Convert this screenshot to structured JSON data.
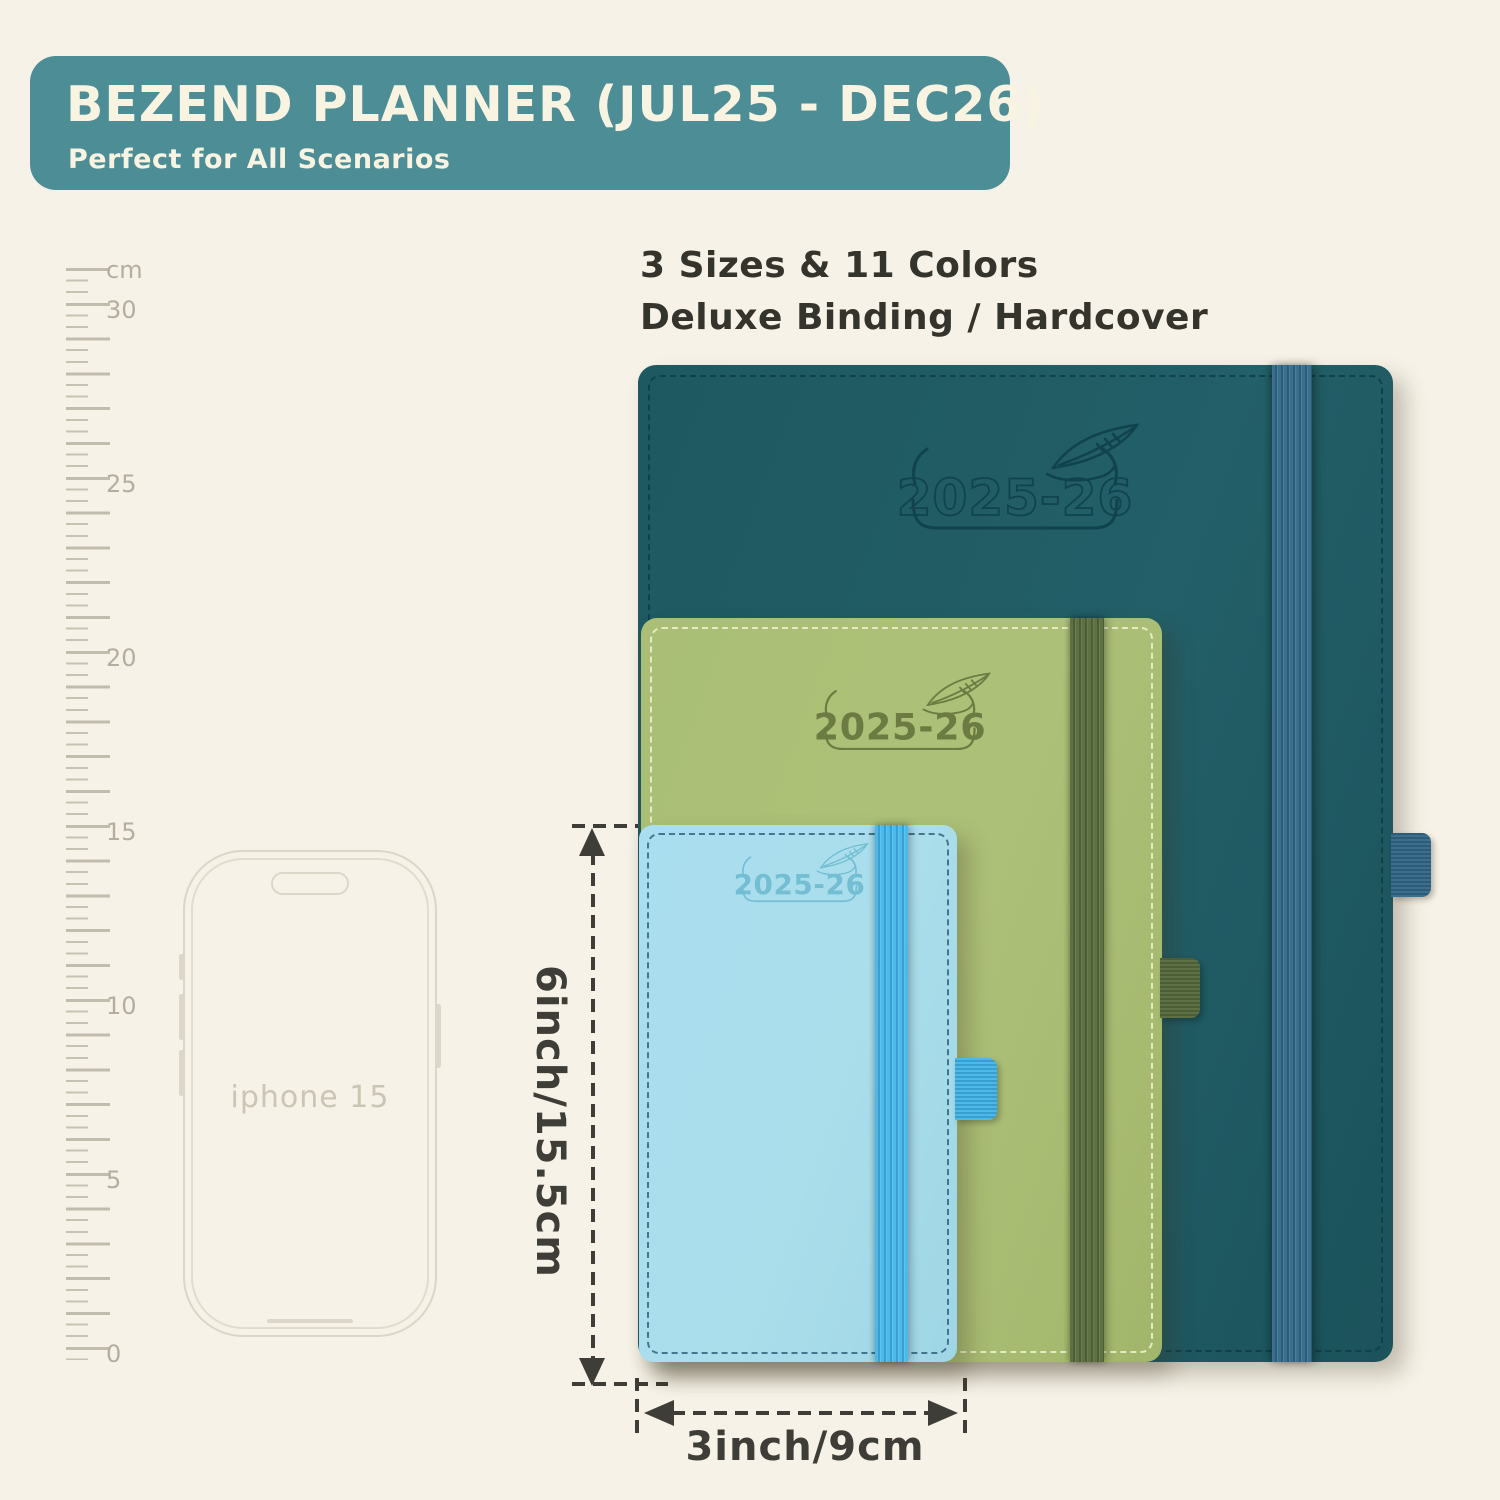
{
  "banner": {
    "title": "BEZEND PLANNER (JUL25 - DEC26)",
    "subtitle": "Perfect for All Scenarios",
    "bg_color": "#4d8d96",
    "text_color": "#f9f4e1"
  },
  "features": {
    "line1": "3 Sizes & 11 Colors",
    "line2": "Deluxe Binding / Hardcover"
  },
  "ruler": {
    "unit": "cm",
    "labels": [
      "30",
      "25",
      "20",
      "15",
      "10",
      "5",
      "0"
    ]
  },
  "phone": {
    "label": "iphone 15"
  },
  "planners": {
    "large": {
      "year": "2025-26",
      "cover_color": "#1f5962",
      "band_color": "#3b6f8d",
      "emboss_color": "#11434d"
    },
    "medium": {
      "year": "2025-26",
      "cover_color": "#a9bd72",
      "band_color": "#5e7145",
      "emboss_color": "#6b7b42"
    },
    "small": {
      "year": "2025-26",
      "cover_color": "#a7dcea",
      "band_color": "#4cb9e9",
      "emboss_color": "#74bed4"
    }
  },
  "dimensions": {
    "height_label": "6inch/15.5cm",
    "width_label": "3inch/9cm"
  }
}
